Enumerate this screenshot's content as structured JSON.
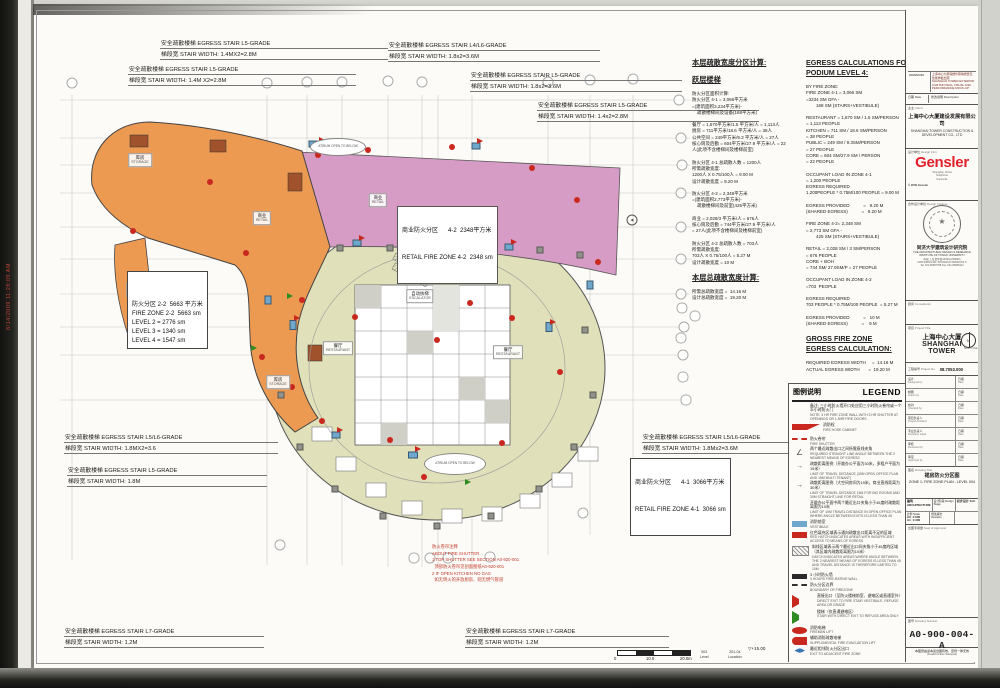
{
  "scan": {
    "timestamp": "8/14/2009 11:28:09 AM"
  },
  "colors": {
    "zone_2_2": "#EC9A52",
    "zone_4_2": "#D79CC6",
    "zone_4_1": "#E0E0BA",
    "fire_red": "#C8281E",
    "vestibule_blue": "#6FA8CC",
    "accent_red": "#E31F2B"
  },
  "stair_annotations": [
    {
      "x": 160,
      "y": 38,
      "w": 228,
      "l1": "安全疏散楼梯 EGRESS STAIR  L5-GRADE",
      "l2": "梯段宽 STAIR WIDTH:       1.4MX2=2.8M"
    },
    {
      "x": 128,
      "y": 64,
      "w": 228,
      "l1": "安全疏散楼梯 EGRESS STAIR   L5-GRADE",
      "l2": "梯段宽 STAIR WIDTH:     1.4M X2=2.8M"
    },
    {
      "x": 388,
      "y": 40,
      "w": 212,
      "l1": "安全疏散楼梯 EGRESS STAIR L4/L6-GRADE",
      "l2": "梯段宽 STAIR WIDTH:      1.8x2=3.6M"
    },
    {
      "x": 470,
      "y": 70,
      "w": 212,
      "l1": "安全疏散楼梯 EGRESS STAIR L5-GRADE",
      "l2": "梯段宽 STAIR WIDTH:      1.8x2=3.6M"
    },
    {
      "x": 537,
      "y": 100,
      "w": 222,
      "l1": "安全疏散楼梯 EGRESS STAIR  L5-GRADE",
      "l2": "梯段宽 STAIR WIDTH:       1.4x2=2.8M"
    },
    {
      "x": 64,
      "y": 432,
      "w": 214,
      "l1": "安全疏散楼梯 EGRESS STAIR  L5/L6-GRADE",
      "l2": "梯段宽 STAIR WIDTH:      1.8MX2=3.6"
    },
    {
      "x": 67,
      "y": 465,
      "w": 200,
      "l1": "安全疏散楼梯 EGRESS STAIR  L5-GRADE",
      "l2": "梯段宽 STAIR WIDTH:         1.8M"
    },
    {
      "x": 642,
      "y": 432,
      "w": 146,
      "l1": "安全疏散楼梯 EGRESS STAIR L5/L6-GRADE",
      "l2": "梯段宽 STAIR WIDTH:  1.8Mx2=3.6M"
    },
    {
      "x": 64,
      "y": 626,
      "w": 200,
      "l1": "安全疏散楼梯 EGRESS STAIR  L7-GRADE",
      "l2": "梯段宽 STAIR WIDTH:         1.2M"
    },
    {
      "x": 465,
      "y": 626,
      "w": 204,
      "l1": "安全疏散楼梯 EGRESS STAIR  L7-GRADE",
      "l2": "梯段宽 STAIR WIDTH:         1.2M"
    }
  ],
  "zone_labels": {
    "fz22_lines": [
      "防火分区 2-2  5663 平方米",
      "FIRE ZONE 2-2  5663 sm",
      "LEVEL 2 = 2776 sm",
      "LEVEL 3 = 1340 sm",
      "LEVEL 4 = 1547 sm"
    ],
    "rz42_l1": "商业防火分区      4-2  2348平方米",
    "rz42_l2": "RETAIL FIRE ZONE 4-2  2348 sm",
    "rz41_l1": "商业防火分区      4-1  3066平方米",
    "rz41_l2": "RETAIL FIRE ZONE 4-1  3066 sm"
  },
  "shutter_note_lines": [
    "防火卷帘注释",
    "ABOUT FIRE SHUTTER",
    "1 TOP SHUTTER SEE SECTION A0-920-001",
    "  顶部防火卷帘见剖面图纸A0-920-001",
    "2 IF OPEN KITCHEN NO GAS",
    "  如无明火的开放厨房、则无燃气管道"
  ],
  "calc_cn_lines": [
    "**本层疏散宽度分区计算:",
    "",
    "**跃层楼梯",
    "",
    "防火分区面积计算:",
    "防火分区 4-1 = 3,066平方米",
    "=(建筑面积3,234平方米)-",
    "    疏散楼梯间及设备(168平方米)",
    "",
    "餐厅 = 1,670平方米/1.5 平方米/人 = 1,113人",
    "厨房 = 711平方米/18.6 平方米/人 = 38人",
    "公共空间 = 249平方米/9.3 平方米/人 = 27人",
    "核心筒及后勤 = 604平方米/27.9 平方米/人 = 22",
    "人(此项不含楼梯间及楼梯前室)",
    "",
    "防火分区 4-1 总疏散人数 = 1200人",
    "所需疏散宽度:",
    "1200人 X 0.75/100人 = 9.00 M",
    "设计疏散宽度 = 9.20 M",
    "",
    "防火分区 4-2 = 2,348平方米",
    "=(建筑面积2,773平方米)-",
    "    疏散楼梯间及前室(425平方米)",
    "",
    "商业 = 2,028/3 平方米/人 = 676人",
    "核心筒及后勤 = 744平方米/27.9 平方米/人",
    "= 27人(此项不含楼梯间及楼梯前室)",
    "",
    "防火分区 4-2 总疏散人数 = 703人",
    "所需疏散宽度:",
    "703人 X 0.75/100人 = 5.27 M",
    "设计疏散宽度 = 10 M",
    "",
    "**本层总疏散宽度计算:",
    "",
    "所需总疏散宽度 =  14.16 M",
    "设计总疏散宽度 =  19.20 M"
  ],
  "calc_en_lines": [
    "**EGRESS CALCULATIONS FOR",
    "**PODIUM LEVEL 4:",
    "",
    "BY FIRE ZONE:",
    "FIRE ZONE 4-1 = 3,066 SM",
    "=3234 SM GFA -",
    "        168 SM (STAIRS+VESTIBULE)",
    "",
    "RESTAURANT = 1,670 SM / 1.5 SM/PERSON",
    "= 1,113 PEOPLE",
    "KITCHEN = 711 SM / 18.6 SM/PERSON",
    "= 38 PEOPLE",
    "PUBLIC = 249 SM / 9.3SM/PERSON",
    "= 27 PEOPLE",
    "CORE = 604 SM/27.9 SM / PERSON",
    "= 22 PEOPLE",
    "",
    "OCCUPANT LOAD IN ZONE 4-1",
    "= 1,200 PEOPLE",
    "EGRESS REQUIRED",
    "1,200PEOPLE * 0.75M/100 PEOPLE = 9.00 M",
    "",
    "EGRESS PROVIDED           =   9.20 M",
    "(SHARED EGRESS)           =   9.20 M",
    "",
    "FIRE ZONE 4-2= 2,348 SM",
    "= 2,773 SM GFA -",
    "        425 SM (STAIRS+VESTIBULE)",
    "",
    "RETAIL = 2,028 SM / 3 SM/PERSON",
    "= 676 PEOPLE",
    "CORE + BOH",
    "= 744 SM/ 27.9SM/P = 27 PEOPLE",
    "",
    "OCCUPANT LOAD IN ZONE 4-2",
    "=703  PEOPLE",
    "",
    "EGRESS REQUIRED",
    "703 PEOPLE * 0.75M/100 PEOPLE  = 5.27 M",
    "",
    "EGRESS PROVIDED           =   10 M",
    "(SHARED EGRESS)           =    9 M",
    "",
    "**GROSS FIRE ZONE",
    "**EGRESS CALCULATION:",
    "",
    "REQUIRED EGRESS WIDTH     =  14.16 M",
    "ACTUAL EGRESS WIDTH       =  19.20 M"
  ],
  "grid_bubbles": [
    {
      "label": "4",
      "x": 72,
      "y": 83
    },
    {
      "label": "8",
      "x": 267,
      "y": 83
    },
    {
      "label": "9",
      "x": 307,
      "y": 82
    },
    {
      "label": "10",
      "x": 342,
      "y": 82
    },
    {
      "label": "11",
      "x": 388,
      "y": 81
    },
    {
      "label": "12",
      "x": 422,
      "y": 82
    },
    {
      "label": "15",
      "x": 548,
      "y": 82
    },
    {
      "label": "16",
      "x": 590,
      "y": 80
    },
    {
      "label": "17",
      "x": 633,
      "y": 79
    },
    {
      "label": "8.1",
      "x": 277,
      "y": 71,
      "cls": "plain"
    },
    {
      "label": "10.7",
      "x": 370,
      "y": 67,
      "cls": "plain"
    },
    {
      "label": "11.6",
      "x": 407,
      "y": 68,
      "cls": "plain"
    },
    {
      "label": "12.4",
      "x": 438,
      "y": 68,
      "cls": "plain"
    },
    {
      "label": "13.3",
      "x": 472,
      "y": 67,
      "cls": "plain"
    },
    {
      "label": "15.3",
      "x": 567,
      "y": 64,
      "cls": "plain"
    },
    {
      "label": "R",
      "x": 679,
      "y": 100
    },
    {
      "label": "Q",
      "x": 681,
      "y": 138
    },
    {
      "label": "P",
      "x": 682,
      "y": 165
    },
    {
      "label": "N",
      "x": 681,
      "y": 193
    },
    {
      "label": "M",
      "x": 681,
      "y": 227
    },
    {
      "label": "L",
      "x": 681,
      "y": 259
    },
    {
      "label": "K",
      "x": 681,
      "y": 294
    },
    {
      "label": "J.8",
      "x": 682,
      "y": 308,
      "cls": "wide"
    },
    {
      "label": "J.7",
      "x": 695,
      "y": 316,
      "cls": "wide"
    },
    {
      "label": "J",
      "x": 684,
      "y": 327
    },
    {
      "label": "H.6",
      "x": 681,
      "y": 338,
      "cls": "wide"
    },
    {
      "label": "H",
      "x": 683,
      "y": 355
    },
    {
      "label": "G.4",
      "x": 683,
      "y": 377,
      "cls": "wide"
    },
    {
      "label": "F.2",
      "x": 686,
      "y": 400,
      "cls": "wide"
    },
    {
      "label": "TT",
      "x": 280,
      "y": 545
    },
    {
      "label": "NN",
      "x": 583,
      "y": 513
    },
    {
      "label": "11.6",
      "x": 414,
      "y": 558,
      "cls": "wide"
    },
    {
      "label": "12",
      "x": 430,
      "y": 558
    },
    {
      "label": "12.4",
      "x": 448,
      "y": 558,
      "cls": "wide"
    },
    {
      "label": "13.3",
      "x": 490,
      "y": 557,
      "cls": "wide"
    }
  ],
  "fire_hose_dots": [
    {
      "x": 318,
      "y": 155
    },
    {
      "x": 368,
      "y": 150
    },
    {
      "x": 452,
      "y": 147
    },
    {
      "x": 532,
      "y": 168
    },
    {
      "x": 577,
      "y": 200
    },
    {
      "x": 598,
      "y": 262
    },
    {
      "x": 133,
      "y": 231
    },
    {
      "x": 210,
      "y": 182
    },
    {
      "x": 246,
      "y": 253
    },
    {
      "x": 302,
      "y": 300
    },
    {
      "x": 262,
      "y": 357
    },
    {
      "x": 292,
      "y": 387
    },
    {
      "x": 322,
      "y": 421
    },
    {
      "x": 424,
      "y": 477
    },
    {
      "x": 502,
      "y": 443
    },
    {
      "x": 560,
      "y": 372
    },
    {
      "x": 470,
      "y": 303
    },
    {
      "x": 408,
      "y": 257
    },
    {
      "x": 355,
      "y": 317
    },
    {
      "x": 512,
      "y": 318
    },
    {
      "x": 437,
      "y": 340
    },
    {
      "x": 390,
      "y": 440
    }
  ],
  "vestibules": [
    {
      "x": 313,
      "y": 144,
      "w": 9,
      "h": 7
    },
    {
      "x": 357,
      "y": 243,
      "w": 9,
      "h": 7
    },
    {
      "x": 509,
      "y": 247,
      "w": 9,
      "h": 7
    },
    {
      "x": 293,
      "y": 325,
      "w": 7,
      "h": 10
    },
    {
      "x": 549,
      "y": 327,
      "w": 7,
      "h": 10
    },
    {
      "x": 413,
      "y": 455,
      "w": 10,
      "h": 7
    },
    {
      "x": 336,
      "y": 435,
      "w": 9,
      "h": 7
    },
    {
      "x": 476,
      "y": 146,
      "w": 9,
      "h": 7
    },
    {
      "x": 590,
      "y": 285,
      "w": 7,
      "h": 9
    },
    {
      "x": 268,
      "y": 300,
      "w": 7,
      "h": 9
    }
  ],
  "columns": [
    {
      "x": 281,
      "y": 395
    },
    {
      "x": 300,
      "y": 447
    },
    {
      "x": 335,
      "y": 489
    },
    {
      "x": 383,
      "y": 516
    },
    {
      "x": 437,
      "y": 526
    },
    {
      "x": 491,
      "y": 516
    },
    {
      "x": 539,
      "y": 489
    },
    {
      "x": 574,
      "y": 447
    },
    {
      "x": 593,
      "y": 395
    },
    {
      "x": 585,
      "y": 330
    },
    {
      "x": 340,
      "y": 248
    },
    {
      "x": 390,
      "y": 248
    },
    {
      "x": 440,
      "y": 248
    },
    {
      "x": 490,
      "y": 248
    },
    {
      "x": 540,
      "y": 250
    },
    {
      "x": 580,
      "y": 255
    }
  ],
  "exit_triangles": [
    {
      "x": 322,
      "y": 140
    },
    {
      "x": 362,
      "y": 238
    },
    {
      "x": 514,
      "y": 242
    },
    {
      "x": 297,
      "y": 318
    },
    {
      "x": 553,
      "y": 322
    },
    {
      "x": 418,
      "y": 449
    },
    {
      "x": 340,
      "y": 430
    },
    {
      "x": 480,
      "y": 141
    },
    {
      "x": 290,
      "y": 296,
      "cls": "green"
    },
    {
      "x": 468,
      "y": 482,
      "cls": "green"
    },
    {
      "x": 254,
      "y": 348,
      "cls": "green"
    }
  ],
  "atriums": [
    {
      "x": 338,
      "y": 147,
      "w": 56,
      "h": 18
    },
    {
      "x": 455,
      "y": 464,
      "w": 62,
      "h": 22
    }
  ],
  "atrium_label": "ATRIUM OPEN TO BELOW",
  "plan_labels": [
    {
      "x": 338,
      "y": 348,
      "cn": "餐厅",
      "en": "RESTAURANT"
    },
    {
      "x": 508,
      "y": 352,
      "cn": "餐厅",
      "en": "RESTAURANT"
    },
    {
      "x": 378,
      "y": 200,
      "cn": "商业",
      "en": "RETAIL"
    },
    {
      "x": 262,
      "y": 218,
      "cn": "商业",
      "en": "RETAIL"
    },
    {
      "x": 140,
      "y": 160,
      "cn": "库房",
      "en": "STORAGE"
    },
    {
      "x": 138,
      "y": 290,
      "cn": "库房",
      "en": "STORAGE"
    },
    {
      "x": 278,
      "y": 382,
      "cn": "库房",
      "en": "STORAGE"
    },
    {
      "x": 420,
      "y": 296,
      "cn": "自动扶梯",
      "en": "ESCALATOR"
    }
  ],
  "legend": {
    "header_cn": "图例说明",
    "header_en": "LEGEND",
    "items": [
      {
        "sym": "none",
        "cn": "备注: 三小时防火墙开口处应用三小时防火卷帘或一个半小时防火门",
        "en": "NOTE: 3 HR FIRE ZONE WALL WITH 3 HR SHUTTER AT OPENINGS OR 1.5HR FIRE DOORS"
      },
      {
        "sym": "wedge",
        "cn": "消防栓",
        "en": "FIRE HOSE CABINET"
      },
      {
        "sym": "dashred",
        "cn": "防火卷帘",
        "en": "FIRE SHUTTER"
      },
      {
        "sym": "angle",
        "cn": "两个最近疏散出口之间所需直线夹角",
        "en": "REQUIRED STRAIGHT LINE ANGLE BETWEEN THE 2 NEAREST MEANS OF EGRESS"
      },
      {
        "sym": "travel",
        "cn": "疏散距离图例（开敞办公平面为30米，多租户平面为15米）",
        "en": "LIMIT OF TRAVEL DISTANCE (30M OPEN OFFICE PLAN AND 15M MULTI TENANT)"
      },
      {
        "sym": "travel2",
        "cn": "疏散距离图例（大空间房间为15米，商业直线距离为30米）",
        "en": "LIMIT OF TRAVEL DISTANCE 15M FOR BIG ROOMS AND 30M STRAIGHT LINE FOR RETAIL"
      },
      {
        "sym": "none",
        "cn": "开敞办公平面中两个最近出口夹角小于45度时疏散距离限为10米",
        "en": "LIMIT OF 10M TRAVEL DISTANCE IN OPEN OFFICE PLAN WHERE ANGLE BETWEEN EXITS IS LESS THAN 45"
      },
      {
        "sym": "bluefill",
        "cn": "消防前室",
        "en": "VESTIBULE"
      },
      {
        "sym": "redfill",
        "cn": "红色填充区域表示通向疏散出口距离不足的区域",
        "en": "RED HATCH INDICATES AREAS WITH INSUFFICIENT ACCESS TO MEANS OF EGRESS"
      },
      {
        "sym": "hatch",
        "cn": "斜线区域表示两个最近出口间夹角小于45度的区域（其区域内疏散距离限为10米）",
        "en": "HATCH INDICATES AREAS WHERE ANGLE BETWEEN THE 2 NEAREST MEANS OF EGRESS IS LESS THAN 45 AND TRAVEL DISTANCE IS THEREFORE LIMITED TO 10M"
      },
      {
        "sym": "wall",
        "cn": "3 小时防火墙",
        "en": "3 HOURS FIRE-RATING WALL"
      },
      {
        "sym": "bound",
        "cn": "防火分区边界",
        "en": "BOUNDARY OF FIREZONE"
      },
      {
        "sym": "trired",
        "cn": "直接出口（至防火楼梯前室、避难区或直通室外）",
        "en": "DIRECT EXIT TO FIRE STAIR VESTIBULE, REFUGE AREA OR GRADE"
      },
      {
        "sym": "trigreen",
        "cn": "楼梯（仅直通避难区）",
        "en": "STAIR WITH DIRECT EXIT TO REFUGE AREA ONLY"
      },
      {
        "sym": "circred",
        "cn": "消防电梯",
        "en": "FIREMAN LIFT"
      },
      {
        "sym": "halfred",
        "cn": "辅助消防疏散电梯",
        "en": "SUPPLEMENTAL FIRE EVACUATION LIFT"
      },
      {
        "sym": "exitblue",
        "cn": "最近相邻防火分区出口",
        "en": "EXIT TO ADJACENT FIRE ZONE"
      }
    ]
  },
  "titleblock": {
    "revision": {
      "date": "2009/06/30",
      "desc_cn": "上海中心大厦塔楼外幕墙视觉及性能样板出图",
      "desc_en": "SHANGHAI TOWER EXTERIOR CURTAIN WALL VISUAL AND PERFORMANCE MOCK-UP"
    },
    "rev_header": {
      "date": "日期 Date",
      "desc": "修改说明 Description"
    },
    "client": {
      "label_cn": "业主",
      "label_en": "Client",
      "name_cn": "上海中心大厦建设发展有限公司",
      "name_en": "SHANGHAI TOWER CONSTRUCTION & DEVELOPMENT CO., LTD"
    },
    "architect": {
      "label_cn": "设计单位",
      "label_en": "Design Firm",
      "logo": "Gensler",
      "addr1": "Shanghai, China",
      "addr2": "Telephone",
      "addr3": "Facsimile",
      "copyright": "© 2009 Gensler"
    },
    "institute": {
      "label_cn": "合作设计单位",
      "label_en": "Design Institute",
      "name_cn": "同济大学建筑设计研究院",
      "name_en": "THE ARCHITECTURAL DESIGN & RESEARCH INSTITUTE OF TONGJI UNIVERSITY",
      "addr_cn": "中国 上海 四平路1239号(200092)",
      "addr_en": "1239 SIPING RD. SHANGHAI 200092 P.R.C",
      "tel": "Tel. 021-65987788  Fax. 021-65983414"
    },
    "consultants": {
      "label_cn": "顾问",
      "label_en": "Consultants"
    },
    "project": {
      "label_cn": "项目",
      "label_en": "Project Title",
      "name_cn": "上海中心大厦",
      "name_en": "SHANGHAI TOWER",
      "north_label": "North to Plan"
    },
    "project_no": {
      "label_cn": "工程编号",
      "label_en": "Project No.",
      "value": "08.7053.000"
    },
    "sig_rows": [
      {
        "cn": "设计",
        "en": "Designed by",
        "dcn": "日期",
        "den": "Date"
      },
      {
        "cn": "制图",
        "en": "Drawn by",
        "dcn": "日期",
        "den": "Date"
      },
      {
        "cn": "校对",
        "en": "Checked by",
        "dcn": "日期",
        "den": "Date"
      },
      {
        "cn": "项目负责人",
        "en": "Project Architect",
        "dcn": "日期",
        "den": "Date"
      },
      {
        "cn": "专业负责人",
        "en": "Discipline Head",
        "dcn": "日期",
        "den": "Date"
      },
      {
        "cn": "审核",
        "en": "Reviewed by",
        "dcn": "日期",
        "den": "Date"
      },
      {
        "cn": "审定",
        "en": "Approved by",
        "dcn": "日期",
        "den": "Date"
      }
    ],
    "title": {
      "label_cn": "图名",
      "label_en": "Drawing Title",
      "name_cn": "裙房防火分区图",
      "name_en": "ZONE 1- FIRE ZONE PLAN - LEVEL 004"
    },
    "meta": {
      "discipline": "建筑 ARCHITECTURE",
      "stage_label": "设计阶段 Design Stage",
      "stage_value": "初步设计 S.D.",
      "scale_label": "比例 Scale",
      "scale_v1": "A3_1:600",
      "scale_v2": "A1_1:300",
      "rev_label": "修改版次 Revision"
    },
    "seal_label": {
      "cn": "出图专用章",
      "en": "Seal of Approval"
    },
    "number": {
      "label_cn": "图号",
      "label_en": "Drawing Number",
      "value": "A0-900-004-A"
    },
    "note_cn": "本图纸由蓝本蓝出图有效，否则一律无效",
    "note_en": "(Invalid Unless Stamped)"
  },
  "scalebar": {
    "t0": "0",
    "t1": "10.0",
    "t2": "20.0m",
    "elevation": "▽+15.00",
    "level_value": "004",
    "level_label": "Level",
    "loc_value": "Z01-04",
    "loc_label": "Location"
  }
}
